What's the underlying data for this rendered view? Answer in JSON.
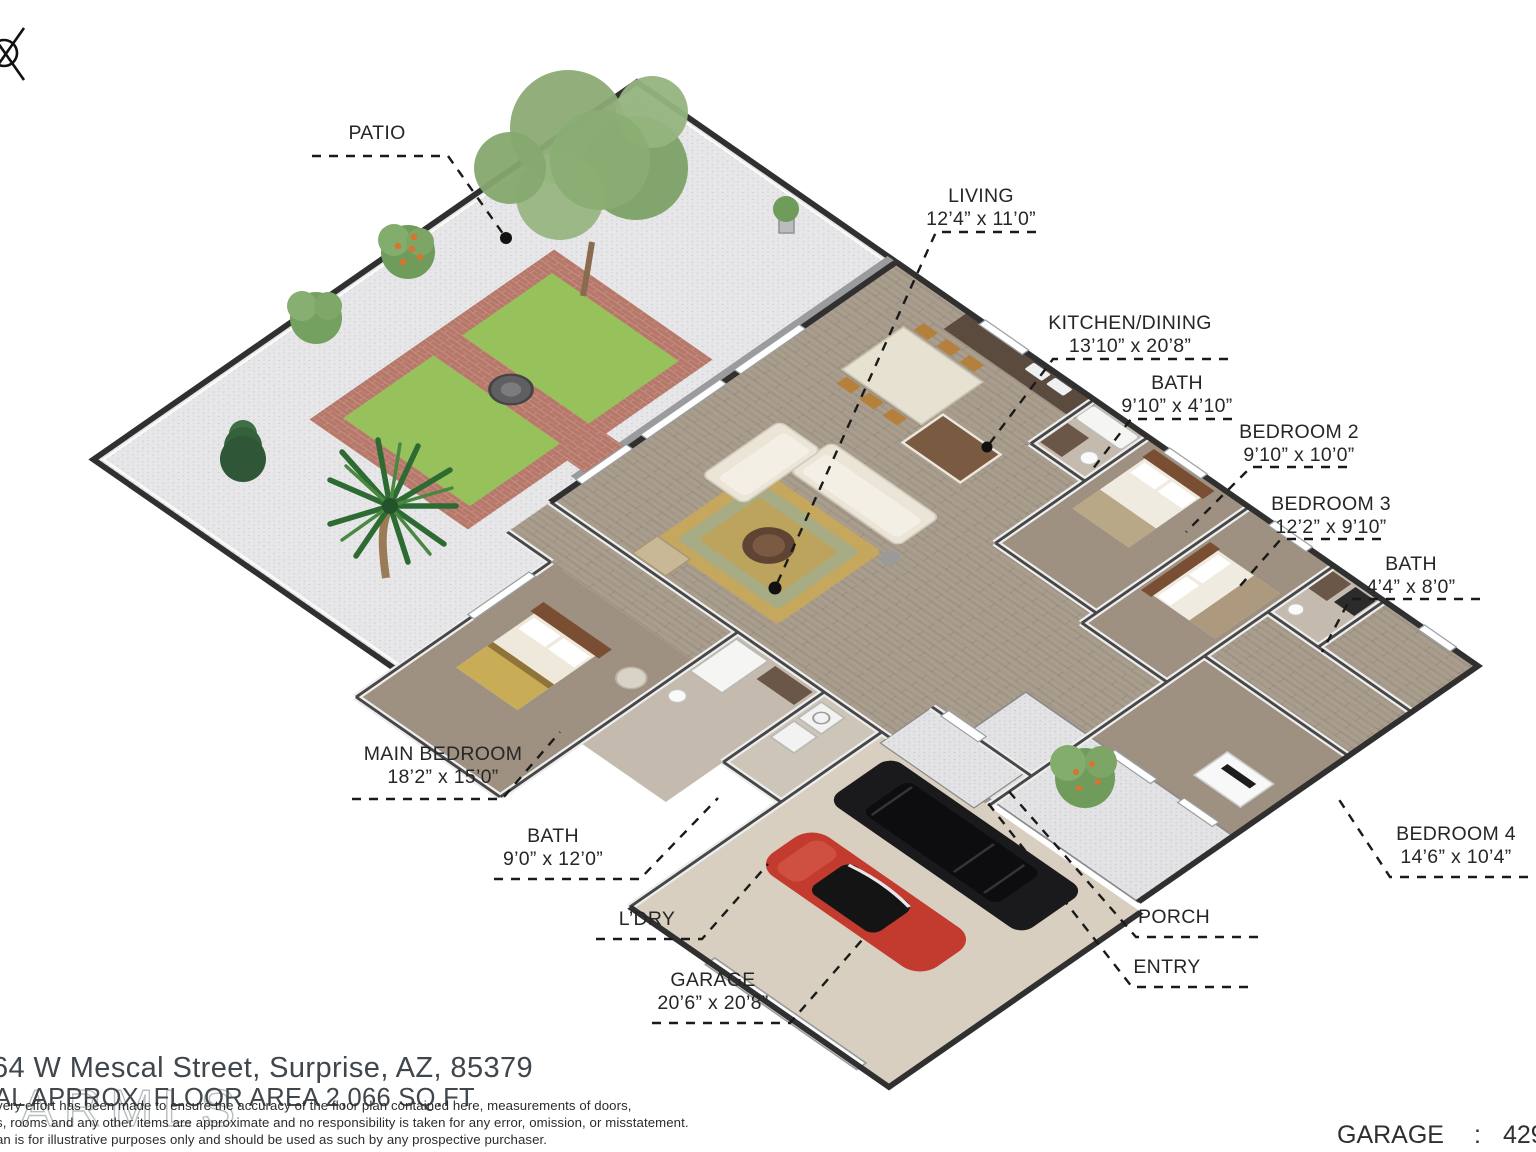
{
  "labels": {
    "patio": {
      "name": "PATIO"
    },
    "living": {
      "name": "LIVING",
      "dims": "12’4” x 11’0”"
    },
    "kitchen_dining": {
      "name": "KITCHEN/DINING",
      "dims": "13’10” x 20’8”"
    },
    "bath_hall": {
      "name": "BATH",
      "dims": "9’10” x 4’10”"
    },
    "bedroom_2": {
      "name": "BEDROOM 2",
      "dims": "9’10” x 10’0”"
    },
    "bedroom_3": {
      "name": "BEDROOM 3",
      "dims": "12’2” x 9’10”"
    },
    "bath_small": {
      "name": "BATH",
      "dims": "4’4” x 8’0”"
    },
    "bedroom_4": {
      "name": "BEDROOM 4",
      "dims": "14’6” x 10’4”"
    },
    "main_bedroom": {
      "name": "MAIN BEDROOM",
      "dims": "18’2” x 15’0”"
    },
    "bath_main": {
      "name": "BATH",
      "dims": "9’0” x 12’0”"
    },
    "laundry": {
      "name": "L’DRY"
    },
    "garage": {
      "name": "GARAGE",
      "dims": "20’6” x 20’8”"
    },
    "porch": {
      "name": "PORCH"
    },
    "entry": {
      "name": "ENTRY"
    }
  },
  "footer": {
    "address": "64 W Mescal Street, Surprise, AZ, 85379",
    "area_line": "AL APPROX. FLOOR AREA 2,066 SQ.FT",
    "disclaimer": [
      "very effort has been made to ensure the accuracy of the floor plan contained here, measurements of doors,",
      "s, rooms and any other items are approximate and no responsibility is taken for any error, omission, or misstatement.",
      "an is for illustrative purposes only and should be used as such by any prospective purchaser."
    ],
    "garage_area": {
      "label": "GARAGE",
      "separator": ":",
      "value": "429 S"
    }
  },
  "watermark_text": "ARMLS",
  "icons": [
    "crossed-circle-icon",
    "large-tree",
    "palm-tree",
    "pine-tree",
    "shrub",
    "orange-tree",
    "fire-pit",
    "potted-plant"
  ],
  "colors": {
    "label_text": "#262626",
    "leader_line": "#1a1a1a",
    "footer_text": "#40474c",
    "disclaimer_text": "#2b2b2b",
    "watermark": "#7d898e",
    "patio_gravel": "#e7e7e9",
    "gravel_dot": "#cdcdd1",
    "walkway_concrete": "#9b9a9c",
    "brick_path": "#b5786a",
    "grass": "#97c25b",
    "wood_floor": "#a79b8c",
    "bedroom_carpet": "#9f9181",
    "tile_floor": "#c4bbae",
    "garage_floor": "#d8cfc0",
    "wall_dark": "#303030",
    "wall_mid": "#474747",
    "wall_light": "#ededed",
    "tree_green": "#7ba166",
    "palm_green": "#2e6b33",
    "car_red": "#c23b2e",
    "car_black": "#1a1a1c",
    "sofa_cream": "#ebe5d8",
    "rug_gold": "#c5a75d",
    "rug_teal": "#8fb0a5",
    "wood_dark": "#7a4e33"
  }
}
